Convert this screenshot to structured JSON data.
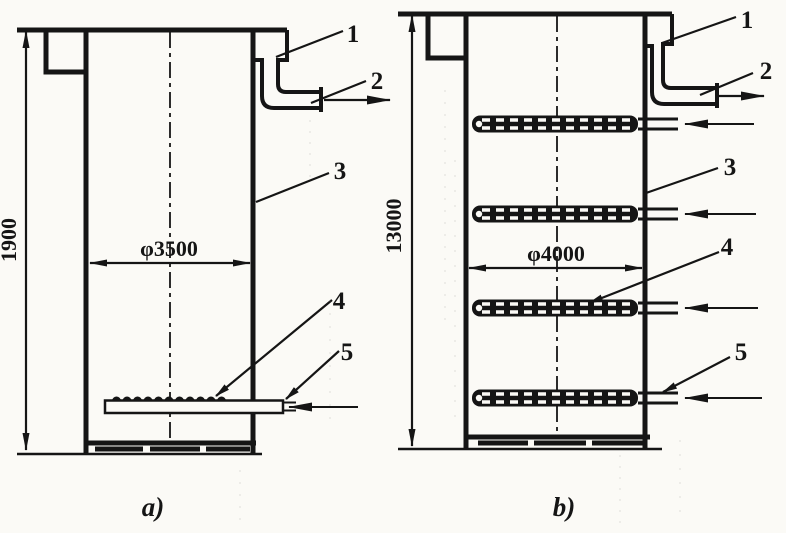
{
  "colors": {
    "ink": "#151515",
    "paper": "#fbfaf6"
  },
  "caption_a": "a)",
  "caption_b": "b)",
  "vessel_a": {
    "height_dim": "1900",
    "diameter_dim": "φ3500",
    "callouts": [
      "1",
      "2",
      "3",
      "4",
      "5"
    ]
  },
  "vessel_b": {
    "height_dim": "13000",
    "diameter_dim": "φ4000",
    "callouts": [
      "1",
      "2",
      "3",
      "4",
      "5"
    ]
  }
}
